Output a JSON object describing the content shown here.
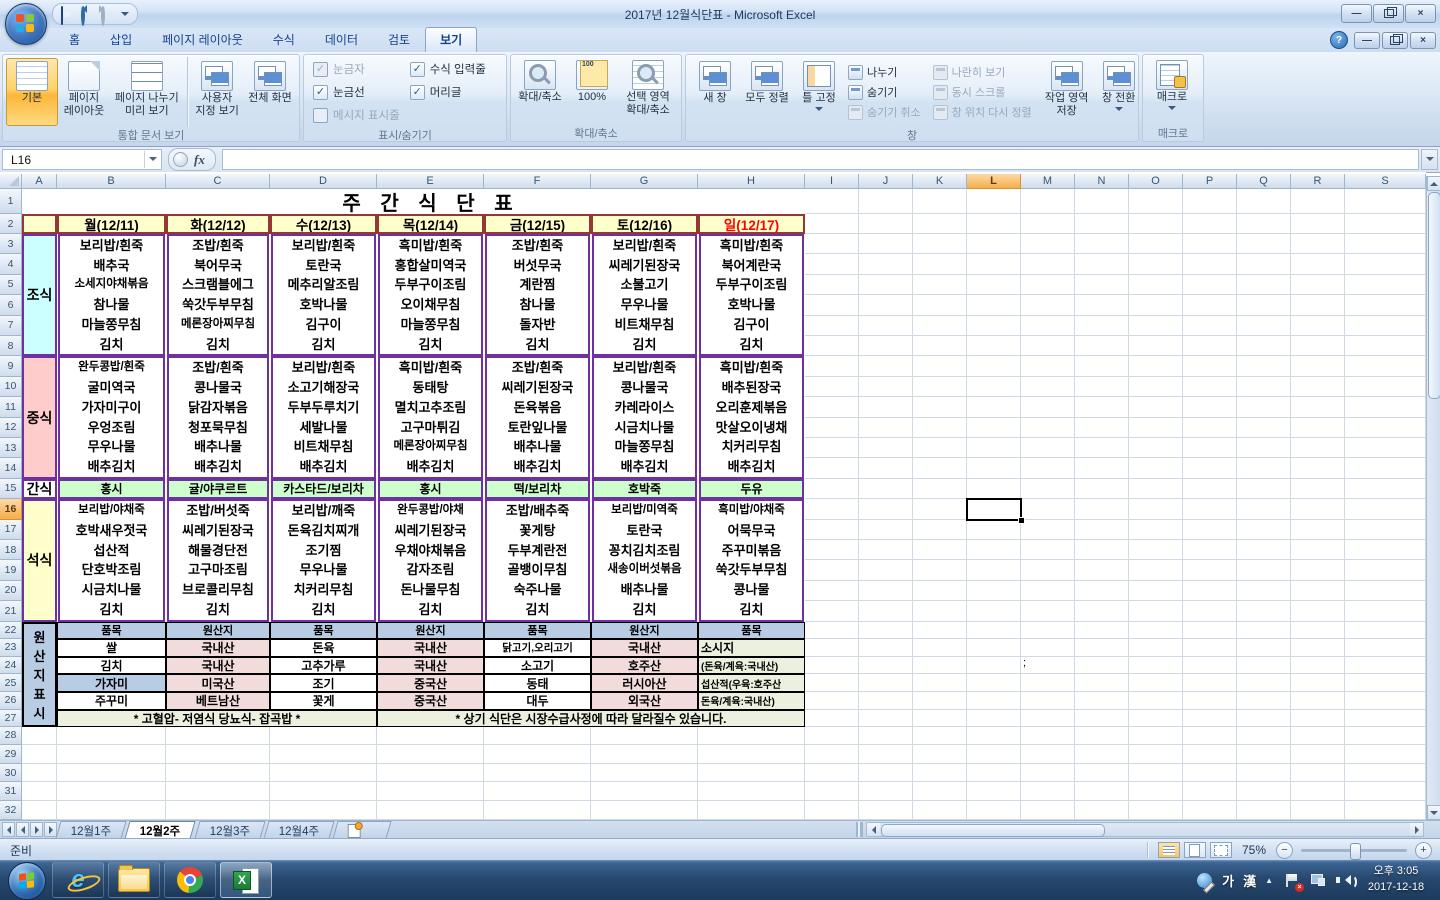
{
  "window": {
    "title": "2017년 12월식단표 - Microsoft Excel",
    "controls": {
      "help": "?",
      "minimize": "—",
      "close": "×"
    }
  },
  "ribbon": {
    "tabs": [
      "홈",
      "삽입",
      "페이지 레이아웃",
      "수식",
      "데이터",
      "검토",
      "보기"
    ],
    "active_tab": "보기",
    "groups": [
      {
        "label": "통합 문서 보기",
        "width": 296,
        "items": [
          {
            "t": "big",
            "label": "기본",
            "icon": "normal-view",
            "active": true
          },
          {
            "t": "big",
            "label": "페이지 레이아웃",
            "icon": "page-layout-view"
          },
          {
            "t": "big",
            "label": "페이지 나누기 미리 보기",
            "icon": "page-break-preview"
          },
          {
            "t": "div"
          },
          {
            "t": "big",
            "label": "사용자 지정 보기",
            "icon": "custom-views"
          },
          {
            "t": "big",
            "label": "전체 화면",
            "icon": "full-screen"
          }
        ]
      },
      {
        "label": "표시/숨기기",
        "width": 202,
        "items": [
          {
            "t": "checks",
            "cols": [
              [
                {
                  "label": "눈금자",
                  "checked": true,
                  "disabled": true
                },
                {
                  "label": "눈금선",
                  "checked": true,
                  "disabled": false
                },
                {
                  "label": "메시지 표시줄",
                  "checked": false,
                  "disabled": true
                }
              ],
              [
                {
                  "label": "수식 입력줄",
                  "checked": true,
                  "disabled": false
                },
                {
                  "label": "머리글",
                  "checked": true,
                  "disabled": false
                }
              ]
            ]
          }
        ]
      },
      {
        "label": "확대/축소",
        "width": 170,
        "items": [
          {
            "t": "big",
            "label": "확대/축소",
            "icon": "zoom"
          },
          {
            "t": "big",
            "label": "100%",
            "icon": "zoom-100"
          },
          {
            "t": "big",
            "label": "선택 영역 확대/축소",
            "icon": "zoom-to-selection"
          }
        ]
      },
      {
        "label": "창",
        "width": 452,
        "items": [
          {
            "t": "big",
            "label": "새 창",
            "icon": "new-window"
          },
          {
            "t": "big",
            "label": "모두 정렬",
            "icon": "arrange-all"
          },
          {
            "t": "big",
            "label": "틀 고정",
            "icon": "freeze-panes",
            "arrow": true
          },
          {
            "t": "smalls",
            "buttons": [
              {
                "label": "나누기",
                "icon": "split",
                "disabled": false
              },
              {
                "label": "숨기기",
                "icon": "hide-window",
                "disabled": false
              },
              {
                "label": "숨기기 취소",
                "icon": "unhide-window",
                "disabled": true
              }
            ]
          },
          {
            "t": "div"
          },
          {
            "t": "smalls",
            "buttons": [
              {
                "label": "나란히 보기",
                "icon": "view-side-by-side",
                "disabled": true
              },
              {
                "label": "동시 스크롤",
                "icon": "synchronous-scrolling",
                "disabled": true
              },
              {
                "label": "창 위치 다시 정렬",
                "icon": "reset-window-position",
                "disabled": true
              }
            ]
          },
          {
            "t": "div"
          },
          {
            "t": "big",
            "label": "작업 영역 저장",
            "icon": "save-workspace"
          },
          {
            "t": "big",
            "label": "창 전환",
            "icon": "switch-windows",
            "arrow": true
          }
        ]
      },
      {
        "label": "매크로",
        "width": 60,
        "items": [
          {
            "t": "big",
            "label": "매크로",
            "icon": "macros",
            "arrow": true
          }
        ]
      }
    ]
  },
  "formula_bar": {
    "name_box": "L16",
    "fx": "fx",
    "value": ""
  },
  "sheet": {
    "columns": [
      "A",
      "B",
      "C",
      "D",
      "E",
      "F",
      "G",
      "H",
      "I",
      "J",
      "K",
      "L",
      "M",
      "N",
      "O",
      "P",
      "Q",
      "R",
      "S"
    ],
    "row_count": 32,
    "selected_cell": "L16",
    "selected_column_index": 11,
    "selected_row_index": 15
  },
  "menu": {
    "title": "주 간 식 단 표",
    "days": [
      "월(12/11)",
      "화(12/12)",
      "수(12/13)",
      "목(12/14)",
      "금(12/15)",
      "토(12/16)",
      "일(12/17)"
    ],
    "sunday_index": 6,
    "sections": [
      {
        "id": "breakfast",
        "label": "조식",
        "label_bg": "#ccffff",
        "cell_bg": "#ffffff",
        "items": [
          [
            "보리밥/흰죽",
            "배추국",
            "소세지야채볶음",
            "참나물",
            "마늘쫑무침",
            "김치"
          ],
          [
            "조밥/흰죽",
            "북어무국",
            "스크램블에그",
            "쑥갓두부무침",
            "메론장아찌무침",
            "김치"
          ],
          [
            "보리밥/흰죽",
            "토란국",
            "메추리알조림",
            "호박나물",
            "김구이",
            "김치"
          ],
          [
            "흑미밥/흰죽",
            "홍합살미역국",
            "두부구이조림",
            "오이채무침",
            "마늘쫑무침",
            "김치"
          ],
          [
            "조밥/흰죽",
            "버섯무국",
            "계란찜",
            "참나물",
            "돌자반",
            "김치"
          ],
          [
            "보리밥/흰죽",
            "씨레기된장국",
            "소불고기",
            "무우나물",
            "비트채무침",
            "김치"
          ],
          [
            "흑미밥/흰죽",
            "북어계란국",
            "두부구이조림",
            "호박나물",
            "김구이",
            "김치"
          ]
        ]
      },
      {
        "id": "lunch",
        "label": "중식",
        "label_bg": "#ffcccc",
        "cell_bg": "#ffffff",
        "items": [
          [
            "완두콩밥/흰죽",
            "굴미역국",
            "가자미구이",
            "우엉조림",
            "무우나물",
            "배추김치"
          ],
          [
            "조밥/흰죽",
            "콩나물국",
            "닭감자볶음",
            "청포묵무침",
            "배추나물",
            "배추김치"
          ],
          [
            "보리밥/흰죽",
            "소고기해장국",
            "두부두루치기",
            "세발나물",
            "비트채무침",
            "배추김치"
          ],
          [
            "흑미밥/흰죽",
            "동태탕",
            "멸치고추조림",
            "고구마튀김",
            "메론장아찌무침",
            "배추김치"
          ],
          [
            "조밥/흰죽",
            "씨레기된장국",
            "돈육볶음",
            "토란잎나물",
            "배추나물",
            "배추김치"
          ],
          [
            "보리밥/흰죽",
            "콩나물국",
            "카레라이스",
            "시금치나물",
            "마늘쫑무침",
            "배추김치"
          ],
          [
            "흑미밥/흰죽",
            "배추된장국",
            "오리훈제볶음",
            "맛살오이냉채",
            "치커리무침",
            "배추김치"
          ]
        ]
      },
      {
        "id": "snack",
        "label": "간식",
        "label_bg": "#ffffff",
        "cell_bg": "#ccffcc",
        "items": [
          "홍시",
          "귤/야쿠르트",
          "카스타드/보리차",
          "홍시",
          "떡/보리차",
          "호박죽",
          "두유"
        ]
      },
      {
        "id": "dinner",
        "label": "석식",
        "label_bg": "#ffffcc",
        "cell_bg": "#ffffff",
        "items": [
          [
            "보리밥/야채죽",
            "호박새우젓국",
            "섭산적",
            "단호박조림",
            "시금치나물",
            "김치"
          ],
          [
            "조밥/버섯죽",
            "씨레기된장국",
            "해물경단전",
            "고구마조림",
            "브로콜리무침",
            "김치"
          ],
          [
            "보리밥/깨죽",
            "돈육김치찌개",
            "조기찜",
            "무우나물",
            "치커리무침",
            "김치"
          ],
          [
            "완두콩밥/야채",
            "씨레기된장국",
            "우채야채볶음",
            "감자조림",
            "돈나물무침",
            "김치"
          ],
          [
            "조밥/배추죽",
            "꽃게탕",
            "두부계란전",
            "골뱅이무침",
            "숙주나물",
            "김치"
          ],
          [
            "보리밥/미역죽",
            "토란국",
            "꽁치김치조림",
            "새송이버섯볶음",
            "배추나물",
            "김치"
          ],
          [
            "흑미밥/야채죽",
            "어묵무국",
            "주꾸미볶음",
            "쑥갓두부무침",
            "콩나물",
            "김치"
          ]
        ]
      }
    ],
    "origin": {
      "label_chars": [
        "원",
        "산",
        "지",
        "표",
        "시"
      ],
      "headers": [
        "품목",
        "원산지",
        "품목",
        "원산지",
        "품목",
        "원산지",
        "품목"
      ],
      "rows": [
        [
          "쌀",
          "국내산",
          "돈육",
          "국내산",
          "닭고기,오리고기",
          "국내산",
          "소시지"
        ],
        [
          "김치",
          "국내산",
          "고추가루",
          "국내산",
          "소고기",
          "호주산",
          "(돈육/계육:국내산)"
        ],
        [
          "가자미",
          "미국산",
          "조기",
          "중국산",
          "동태",
          "러시아산",
          "섭산적(우육:호주산"
        ],
        [
          "주꾸미",
          "베트남산",
          "꽃게",
          "중국산",
          "대두",
          "외국산",
          "돈육/계육:국내산)"
        ]
      ],
      "note_left": "* 고혈압- 저염식   당뇨식- 잡곡밥 *",
      "note_right": "* 상기 식단은 시장수급사정에 따라 달라질수 있습니다.",
      "stray": ";"
    }
  },
  "colors": {
    "table_border": "#7030a0",
    "header_border": "#953735",
    "day_header_bg": "#ffffcc",
    "sunday_text": "#ff0000",
    "origin_header_bg": "#b8cce4",
    "origin_value_bg": "#f2dcdb",
    "origin_info_bg": "#ebf1de",
    "note_bg": "#ebf1de",
    "origin_item_special_bg": "#b8cce4"
  },
  "sheet_tabs": {
    "tabs": [
      "12월1주",
      "12월2주",
      "12월3주",
      "12월4주"
    ],
    "active": "12월2주"
  },
  "status_bar": {
    "ready": "준비",
    "zoom_level": "75%",
    "zoom_out": "−",
    "zoom_in": "+"
  },
  "taskbar": {
    "ime_ko": "가",
    "ime_han": "漢",
    "tray_expand": "▲",
    "clock_time": "오후 3:05",
    "clock_date": "2017-12-18"
  }
}
